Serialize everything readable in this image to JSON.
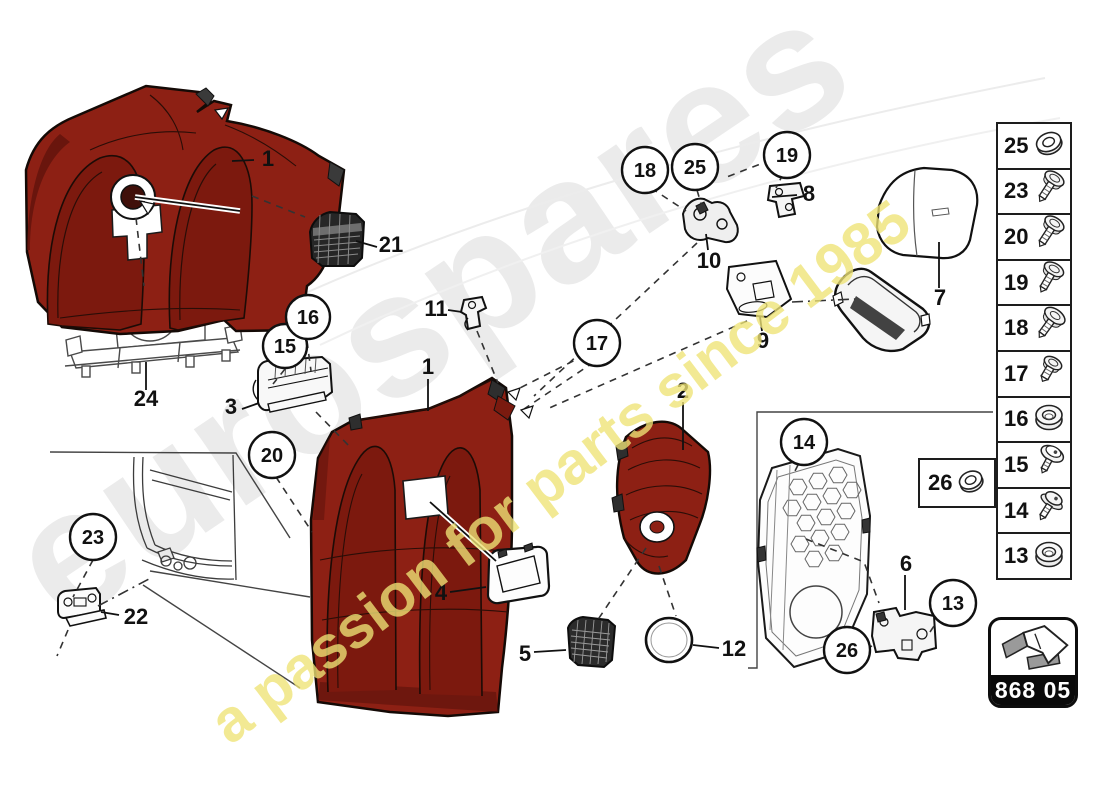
{
  "watermarks": {
    "brand": "eurospares",
    "tagline": "a passion for parts since 1985"
  },
  "page_code": {
    "label": "868 05",
    "icon": "direction-arrow-3d"
  },
  "fasteners_panel": {
    "items": [
      {
        "id": "25",
        "icon": "washer-nut"
      },
      {
        "id": "23",
        "icon": "screw"
      },
      {
        "id": "20",
        "icon": "screw"
      },
      {
        "id": "19",
        "icon": "screw"
      },
      {
        "id": "18",
        "icon": "screw"
      },
      {
        "id": "17",
        "icon": "screw-short"
      },
      {
        "id": "16",
        "icon": "grommet"
      },
      {
        "id": "15",
        "icon": "washer-screw"
      },
      {
        "id": "14",
        "icon": "washer-screw"
      },
      {
        "id": "13",
        "icon": "grommet"
      }
    ]
  },
  "aux_item": {
    "id": "26",
    "icon": "washer-nut"
  },
  "diagram": {
    "plain_labels": [
      {
        "t": "1"
      },
      {
        "t": "21"
      },
      {
        "t": "24"
      },
      {
        "t": "3"
      },
      {
        "t": "11"
      },
      {
        "t": "10"
      },
      {
        "t": "8"
      },
      {
        "t": "9"
      },
      {
        "t": "7"
      },
      {
        "t": "2"
      },
      {
        "t": "1"
      },
      {
        "t": "4"
      },
      {
        "t": "5"
      },
      {
        "t": "12"
      },
      {
        "t": "22"
      },
      {
        "t": "6"
      }
    ],
    "circle_labels": [
      {
        "t": "23"
      },
      {
        "t": "20"
      },
      {
        "t": "15"
      },
      {
        "t": "16"
      },
      {
        "t": "18"
      },
      {
        "t": "25"
      },
      {
        "t": "19"
      },
      {
        "t": "17"
      },
      {
        "t": "14"
      },
      {
        "t": "13"
      },
      {
        "t": "26"
      }
    ]
  },
  "colors": {
    "panel_red": "#8d2014",
    "panel_red_dark": "#5e120b",
    "outline_black": "#141414",
    "watermark_gray": "#ebebeb",
    "watermark_yellow": "#efe476",
    "code_bar_black": "#0a0a0a"
  }
}
